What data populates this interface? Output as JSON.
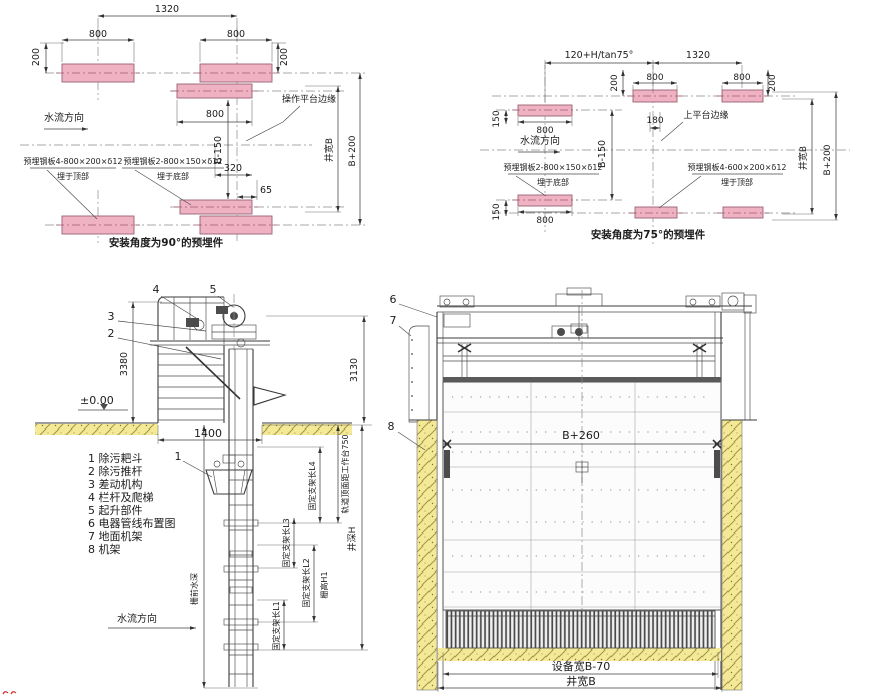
{
  "colors": {
    "plate_fill": "#eeb2c3",
    "plate_stroke": "#9a6374",
    "ground_hatch": "#f3e996",
    "line": "#3b3b3b"
  },
  "panel_90": {
    "caption": "安装角度为90°的预埋件",
    "dim_1320": "1320",
    "dim_800": "800",
    "dim_200": "200",
    "dim_b150": "B-150",
    "dim_320": "320",
    "dim_65": "65",
    "well_width": "井宽B",
    "dim_b200": "B+200",
    "flow": "水流方向",
    "platform_edge": "操作平台边缘",
    "plate_top_spec": "预埋钢板4-800×200×δ12",
    "plate_top_loc": "埋于顶部",
    "plate_bottom_spec": "预埋钢板2-800×150×δ12",
    "plate_bottom_loc": "埋于底部"
  },
  "panel_75": {
    "caption": "安装角度为75°的预埋件",
    "dim_offset": "120+H/tan75°",
    "dim_1320": "1320",
    "dim_800": "800",
    "dim_200": "200",
    "dim_150": "150",
    "dim_180": "180",
    "dim_b150": "B-150",
    "well_width": "井宽B",
    "dim_b200": "B+200",
    "flow": "水流方向",
    "platform_edge": "上平台边缘",
    "plate_bottom_spec": "预埋钢板2-800×150×δ12",
    "plate_bottom_loc": "埋于底部",
    "plate_top_spec": "预埋钢板4-600×200×δ12",
    "plate_top_loc": "埋于顶部"
  },
  "side_view": {
    "callouts": {
      "n1": "1",
      "n2": "2",
      "n3": "3",
      "n4": "4",
      "n5": "5"
    },
    "dim_3380": "3380",
    "dim_3130": "3130",
    "level": "±0.00",
    "dim_1400": "1400",
    "flow": "水流方向",
    "labels": {
      "rail_top": "轨道顶面距工作台750",
      "l4": "固定支架长L4",
      "l3": "固定支架长L3",
      "l2": "固定支架长L2",
      "l1": "固定支架长L1",
      "screen_height": "栅高H1",
      "well_depth": "井深H",
      "water_depth": "栅前水深"
    },
    "parts_list": [
      "1 除污耙斗",
      "2 除污推杆",
      "3 差动机构",
      "4 栏杆及爬梯",
      "5 起升部件",
      "6 电器管线布置图",
      "7 地面机架",
      "8 机架"
    ]
  },
  "front_view": {
    "callouts": {
      "n6": "6",
      "n7": "7",
      "n8": "8"
    },
    "dim_width": "B+260",
    "dim_equip": "设备宽B-70",
    "dim_well": "井宽B"
  }
}
